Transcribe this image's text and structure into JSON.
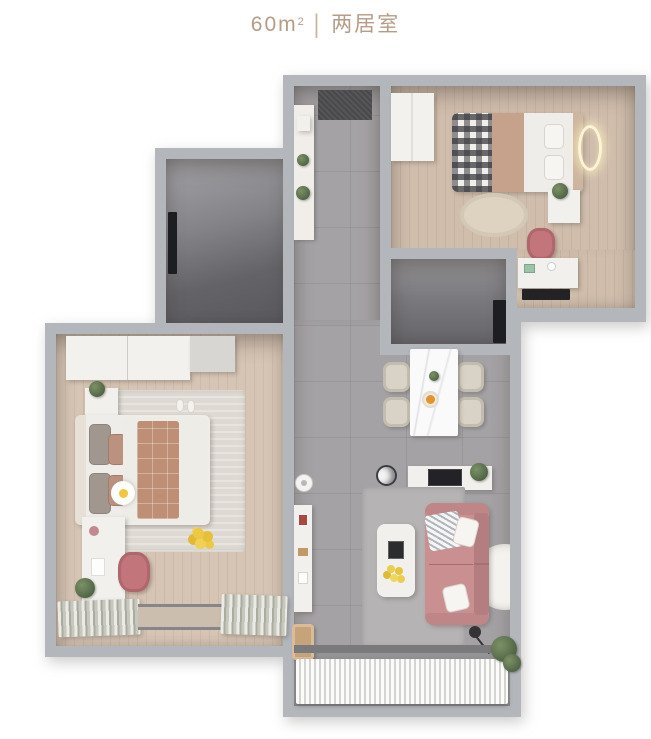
{
  "header": {
    "area_value": "60",
    "area_unit": "m",
    "area_unit_exponent": "2",
    "divider": "|",
    "layout_type": "两居室"
  },
  "palette": {
    "title_text": "#b59c85",
    "background": "#ffffff",
    "wall": "#b3b6bb",
    "wood_floor": "#d0bdac",
    "tile_floor": "#a5a2a5",
    "dark_room_floor": "#6a696d",
    "balcony_floor": "#949396",
    "sofa_pink": "#c98f91",
    "chair_pink": "#c2767c",
    "dining_chair_beige": "#d8d3c6",
    "bed_plaid_terracotta": "#bf8f75",
    "rug_light": "#dedad3",
    "plant_green": "#5b6f4d",
    "accent_yellow": "#ecc843",
    "entry_mat": "#49494b"
  }
}
